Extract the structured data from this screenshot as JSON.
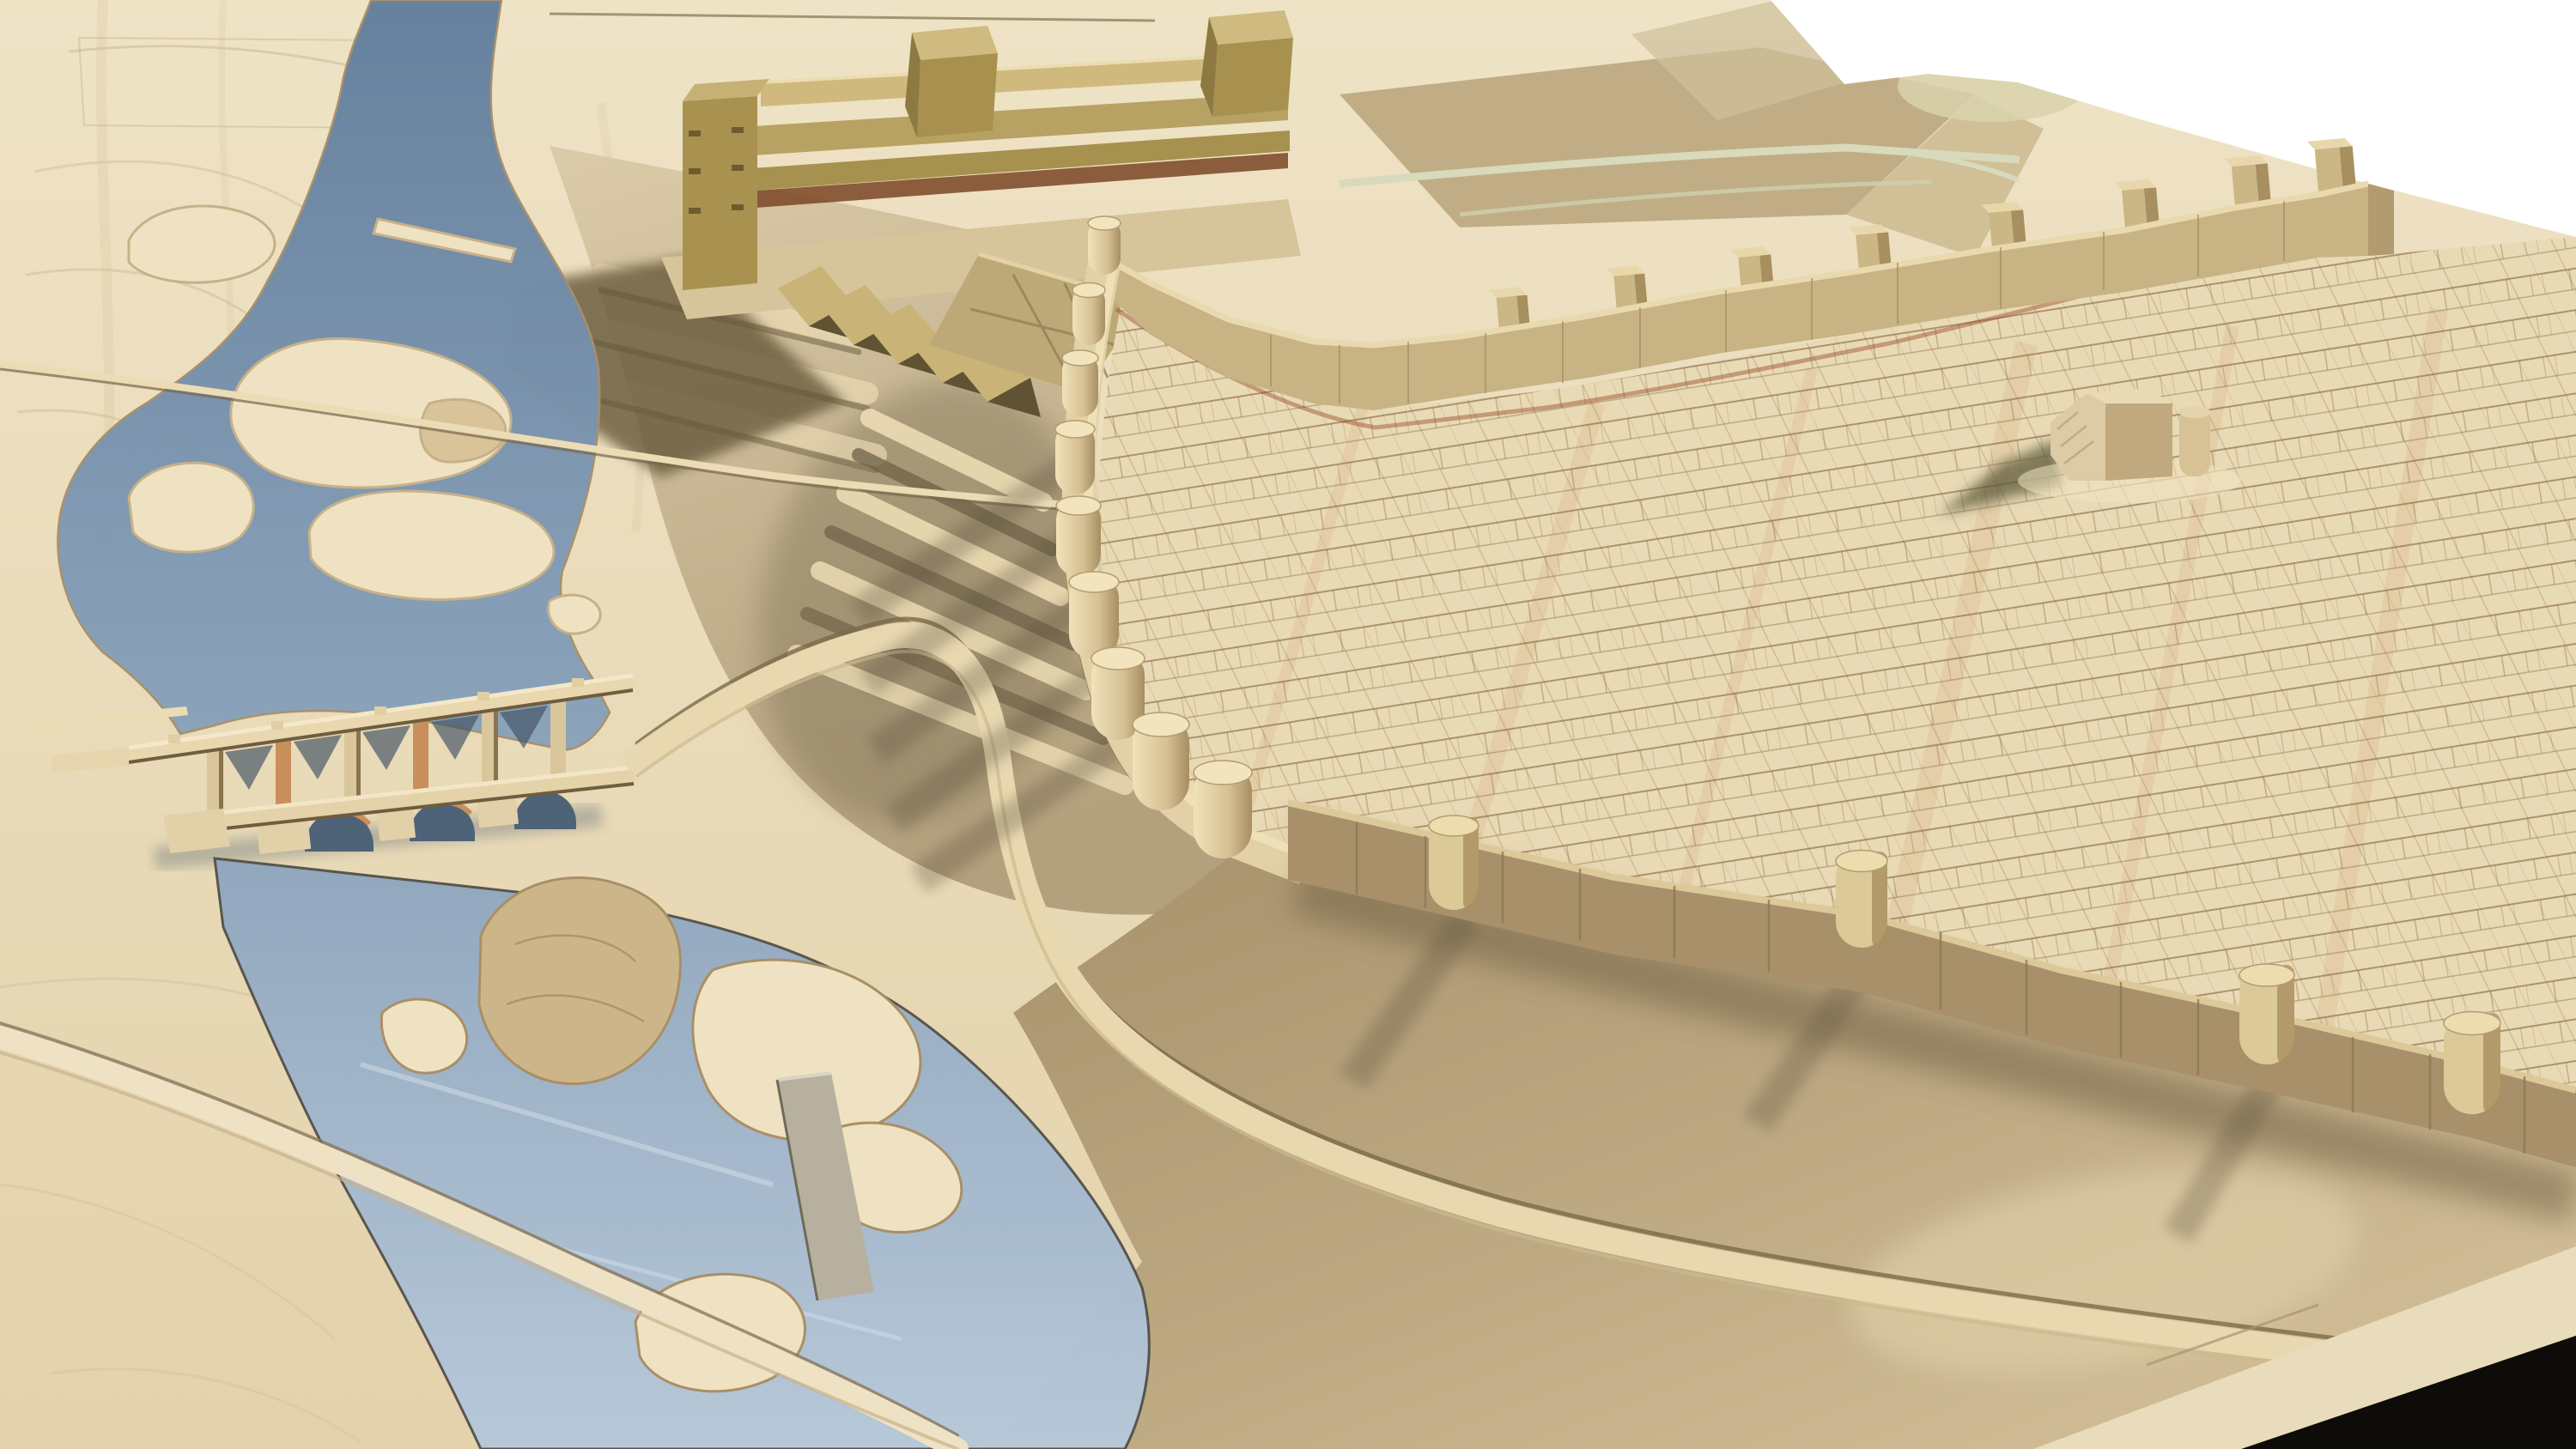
{
  "meta": {
    "type": "photograph",
    "subject": "wooden landscape model of a fortified hill town beside a river",
    "presentation": "cut-out photo on white background, black model-base corner visible bottom right"
  },
  "colors": {
    "white": "#ffffff",
    "wood_base": "#ecdfc2",
    "wood_base_deep": "#e2d0a8",
    "river": "#64809e",
    "lake": "#93a9c0",
    "plateau": "#e9dab6",
    "street_lines": "#8a6a42",
    "wall_light": "#c7b383",
    "wall_dark": "#a8906a",
    "post": "#e3d2a8",
    "building": "#b7a263",
    "building_shadow": "#66593a",
    "road": "#e8d8b0",
    "island": "#efe2c2",
    "island_tan": "#cdb58a",
    "slope_shadow": "#877a5d",
    "causeway": "#b8b09e",
    "house": "#ddcba6",
    "black_base": "#0d0c09"
  },
  "scene": {
    "background": "white studio cut-out",
    "counts": {
      "left_wall_posts": 9,
      "top_wall_merlons": 8,
      "bottom_wall_posts": 4,
      "bridge_arches": 3,
      "bridge_piers": 6
    },
    "elements": [
      {
        "name": "river",
        "desc": "steel-blue river winding from the top left with pale carved sandbank islands"
      },
      {
        "name": "arched-bridges",
        "desc": "two parallel wooden bridges, an upper trestle with piers and a lower round-arched bridge"
      },
      {
        "name": "modern-building-complex",
        "desc": "olive-stained slab building with two block towers and zig-zag terraced roofs"
      },
      {
        "name": "terraced-slope",
        "desc": "carved contour terraces and a switchback road climbing toward the city"
      },
      {
        "name": "city-plateau",
        "desc": "raised old-town plateau engraved with a cadastral street plan"
      },
      {
        "name": "city-wall",
        "desc": "curved rampart band studded with round dowel posts and square merlons"
      },
      {
        "name": "cathedral-block",
        "desc": "small gabled building with an apse standing alone on the plateau"
      },
      {
        "name": "plateau-base-road",
        "desc": "road sweeping around the foot of the plateau, striped by post shadows"
      },
      {
        "name": "causeway",
        "desc": "straight grey weir crossing the lower lake"
      },
      {
        "name": "model-base-corner",
        "desc": "black table corner at bottom right"
      }
    ]
  }
}
